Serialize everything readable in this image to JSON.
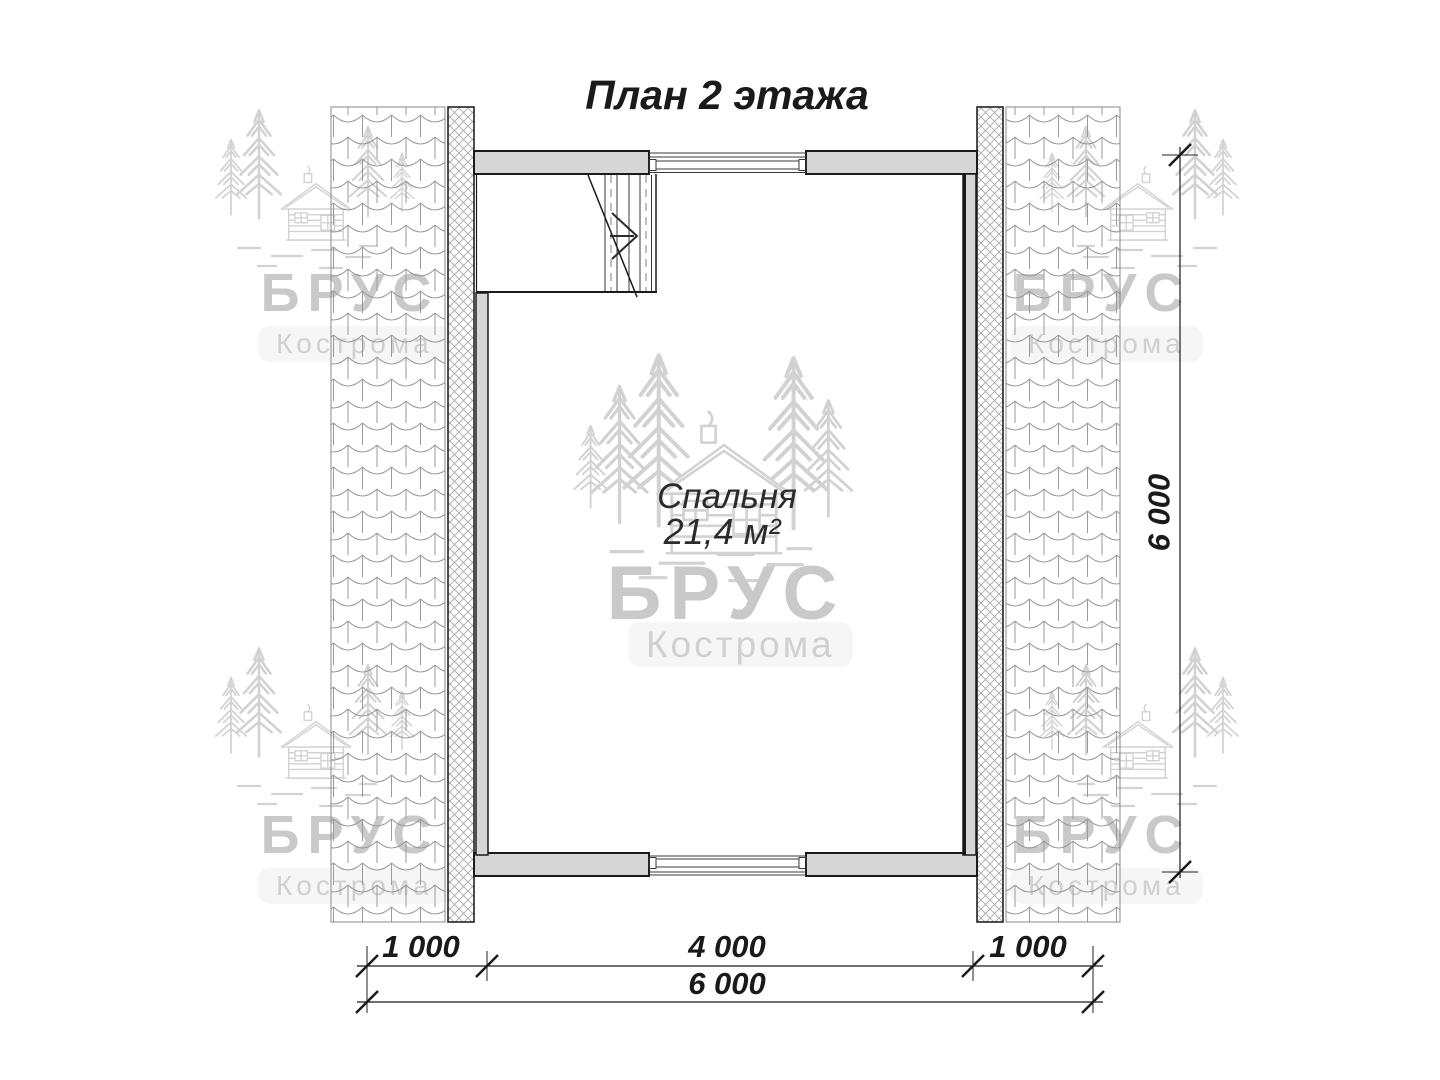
{
  "title": "План 2 этажа",
  "room": {
    "name": "Спальня",
    "area": "21,4 м²"
  },
  "dimensions": {
    "bottom_segments": [
      "1 000",
      "4 000",
      "1 000"
    ],
    "bottom_total": "6 000",
    "right_height": "6 000"
  },
  "watermark": {
    "brand": "БРУС",
    "city": "Кострома"
  },
  "colors": {
    "line": "#1a1a1a",
    "wall": "#d6d6d6",
    "hatch": "#9a9a9a",
    "wm": "#d2d2d2",
    "brand": "#c9c9c9",
    "city": "#d0d0d0",
    "text": "#1a1a1a",
    "bg": "#ffffff"
  }
}
